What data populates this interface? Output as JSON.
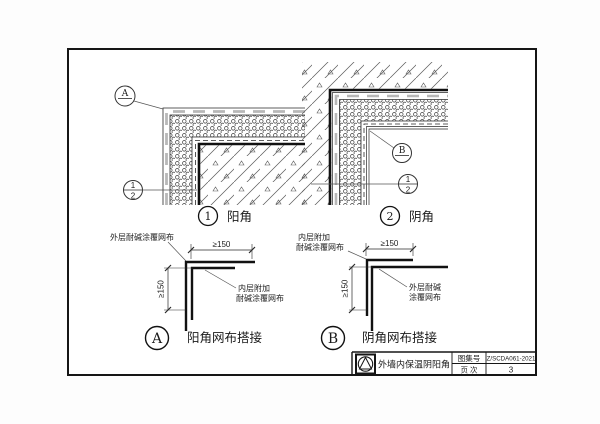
{
  "sheet": {
    "bg_color": "#fdfdfd",
    "line_color": "#1b1b1b",
    "finish_dash_color": "#b8b8b8"
  },
  "details": {
    "d1": {
      "number": "1",
      "title": "阳角",
      "bubble_letter": "A",
      "ref_top": "1",
      "ref_bottom": "2"
    },
    "d2": {
      "number": "2",
      "title": "阴角",
      "bubble_letter": "B",
      "ref_top": "1",
      "ref_bottom": "2"
    },
    "a": {
      "letter": "A",
      "title": "阳角网布搭接",
      "label_outer": "外层耐碱涂覆网布",
      "label_inner_line1": "内层附加",
      "label_inner_line2": "耐碱涂覆网布",
      "dim_h": "≥150",
      "dim_v": "≥150"
    },
    "b": {
      "letter": "B",
      "title": "阴角网布搭接",
      "label_inner_line1": "内层附加",
      "label_inner_line2": "耐碱涂覆网布",
      "label_outer_line1": "外层耐碱",
      "label_outer_line2": "涂覆网布",
      "dim_h": "≥150",
      "dim_v": "≥150"
    }
  },
  "title_block": {
    "drawing_title": "外墙内保温阴阳角",
    "atlas_label": "图集号",
    "atlas_no": "Z/SCDA061-2021",
    "page_label": "页  次",
    "page_no": "3",
    "logo": "triangle-in-circle"
  }
}
